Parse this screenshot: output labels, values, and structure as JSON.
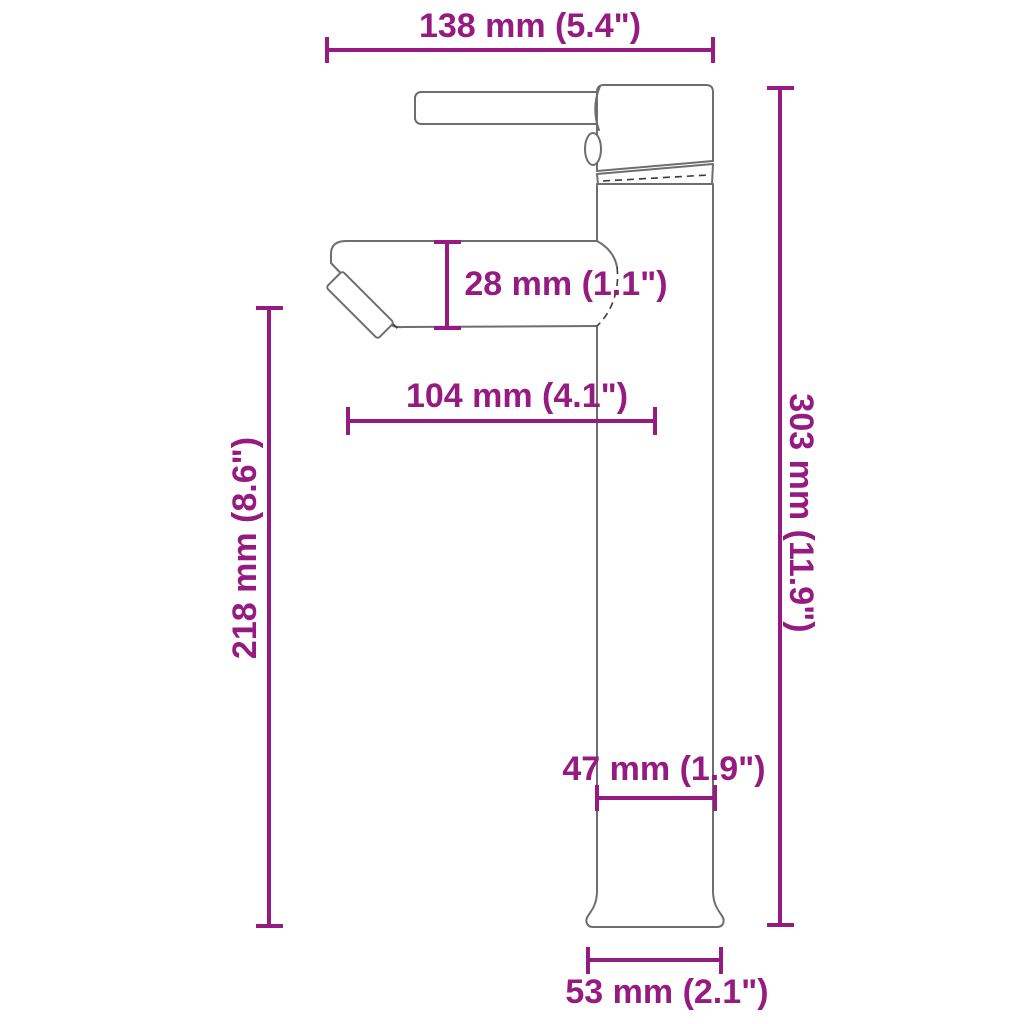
{
  "colors": {
    "dimension_accent": "#951B81",
    "outline": "#6e6e6e",
    "background": "#ffffff"
  },
  "dimensions": {
    "width_top": {
      "mm": 138,
      "inch": "5.4",
      "label": "138 mm (5.4\")"
    },
    "spout_height": {
      "mm": 28,
      "inch": "1.1",
      "label": "28 mm (1.1\")"
    },
    "spout_reach": {
      "mm": 104,
      "inch": "4.1",
      "label": "104 mm (4.1\")"
    },
    "height_to_spout": {
      "mm": 218,
      "inch": "8.6",
      "label": "218 mm (8.6\")"
    },
    "total_height": {
      "mm": 303,
      "inch": "11.9",
      "label": "303 mm (11.9\")"
    },
    "column_width": {
      "mm": 47,
      "inch": "1.9",
      "label": "47 mm (1.9\")"
    },
    "base_width": {
      "mm": 53,
      "inch": "2.1",
      "label": "53 mm (2.1\")"
    }
  }
}
